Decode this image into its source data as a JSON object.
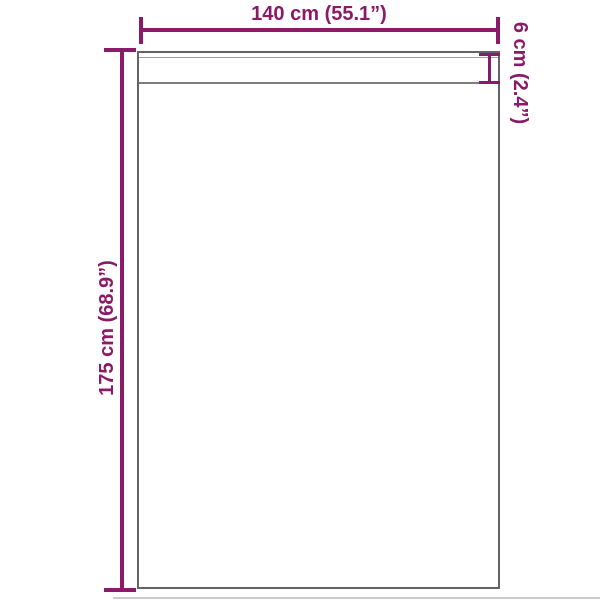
{
  "diagram": {
    "type": "product-dimension-diagram",
    "labels": {
      "width": "140 cm (55.1”)",
      "height": "175 cm (68.9”)",
      "hem": "6 cm (2.4”)"
    },
    "colors": {
      "dimension_accent": "#8b1a68",
      "outline": "#646464",
      "hem_line_upper": "#9e9e9e",
      "hem_line_lower": "#7e7e7e",
      "floor_shadow": "#cbcbcb",
      "background": "#ffffff"
    }
  }
}
